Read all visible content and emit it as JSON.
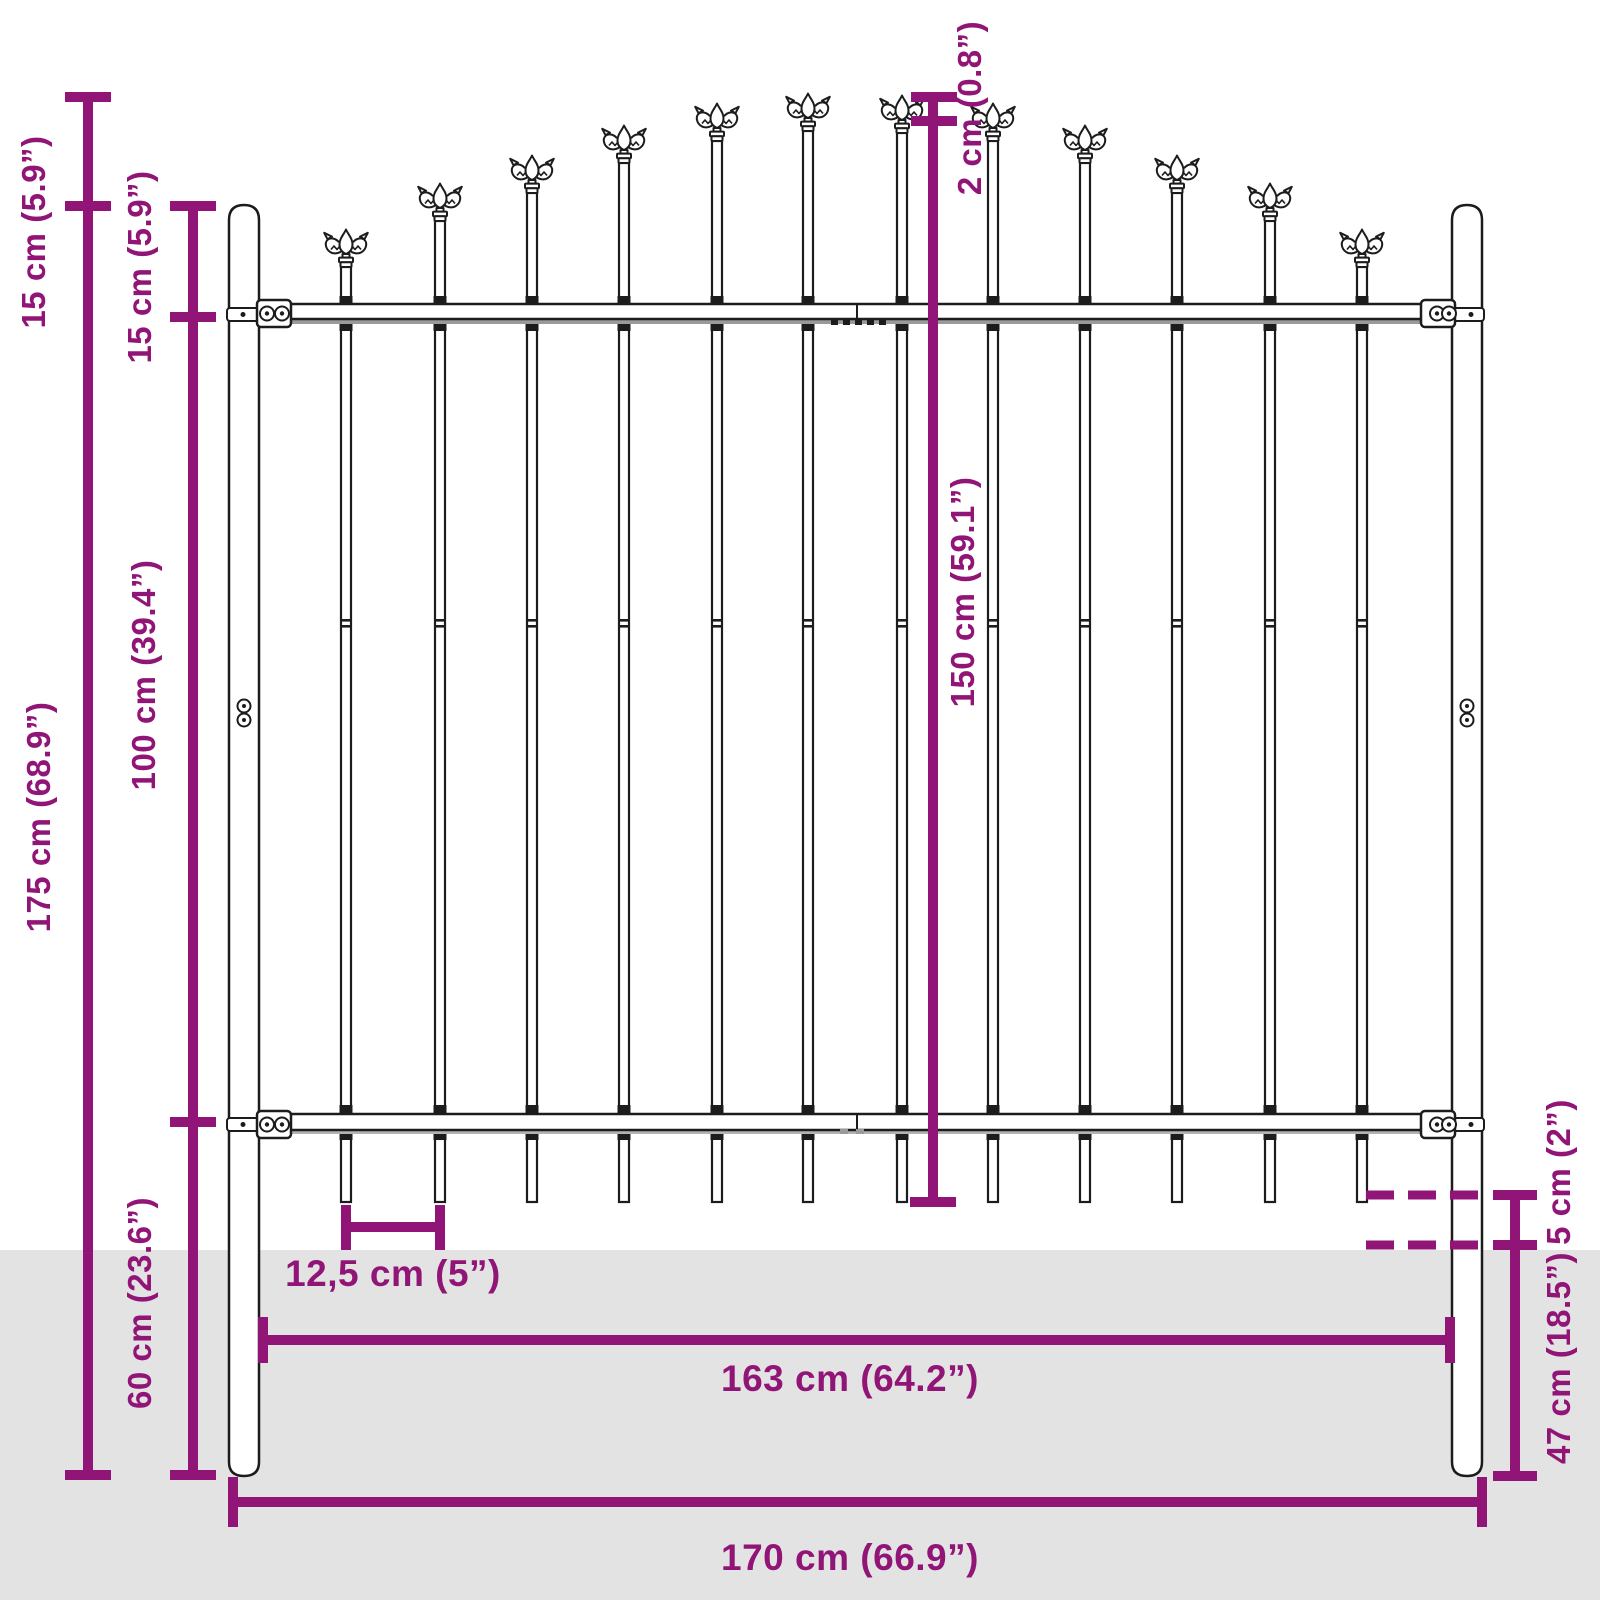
{
  "title": "Garden fence panel with spear top - dimension diagram",
  "colors": {
    "dimension_purple": "#911577",
    "ground_gray": "#E3E3E3",
    "line_black": "#1C1C1C"
  },
  "labels": {
    "tip_to_post_top": "15 cm (5.9”)",
    "post_top_to_rail": "15 cm (5.9”)",
    "rail_to_rail": "100 cm (39.4”)",
    "total_height": "175 cm (68.9”)",
    "below_rail_depth": "60 cm (23.6”)",
    "spear_step": "2 cm (0.8”)",
    "panel_height": "150 cm (59.1”)",
    "above_ground": "5 cm (2”)",
    "post_in_ground": "47 cm (18.5”)",
    "picket_spacing": "12,5 cm (5”)",
    "panel_width": "163 cm (64.2”)",
    "total_width": "170 cm (66.9”)"
  },
  "diagram": {
    "ground_top_y": 1250,
    "picket_bottom_y": 1202,
    "joint_y": 619,
    "pickets": [
      {
        "x": 346,
        "tip": 229
      },
      {
        "x": 440,
        "tip": 183
      },
      {
        "x": 532,
        "tip": 155
      },
      {
        "x": 624,
        "tip": 125
      },
      {
        "x": 717,
        "tip": 103
      },
      {
        "x": 808,
        "tip": 93
      },
      {
        "x": 902,
        "tip": 95
      },
      {
        "x": 993,
        "tip": 103
      },
      {
        "x": 1085,
        "tip": 125
      },
      {
        "x": 1177,
        "tip": 155
      },
      {
        "x": 1270,
        "tip": 183
      },
      {
        "x": 1362,
        "tip": 229
      }
    ],
    "posts": {
      "left_x": 229,
      "right_x": 1452,
      "width": 30,
      "top_y": 205,
      "bottom_y": 1476
    },
    "rails": {
      "top_rail_y": 304,
      "bottom_rail_y": 1114,
      "thickness": 15
    }
  }
}
